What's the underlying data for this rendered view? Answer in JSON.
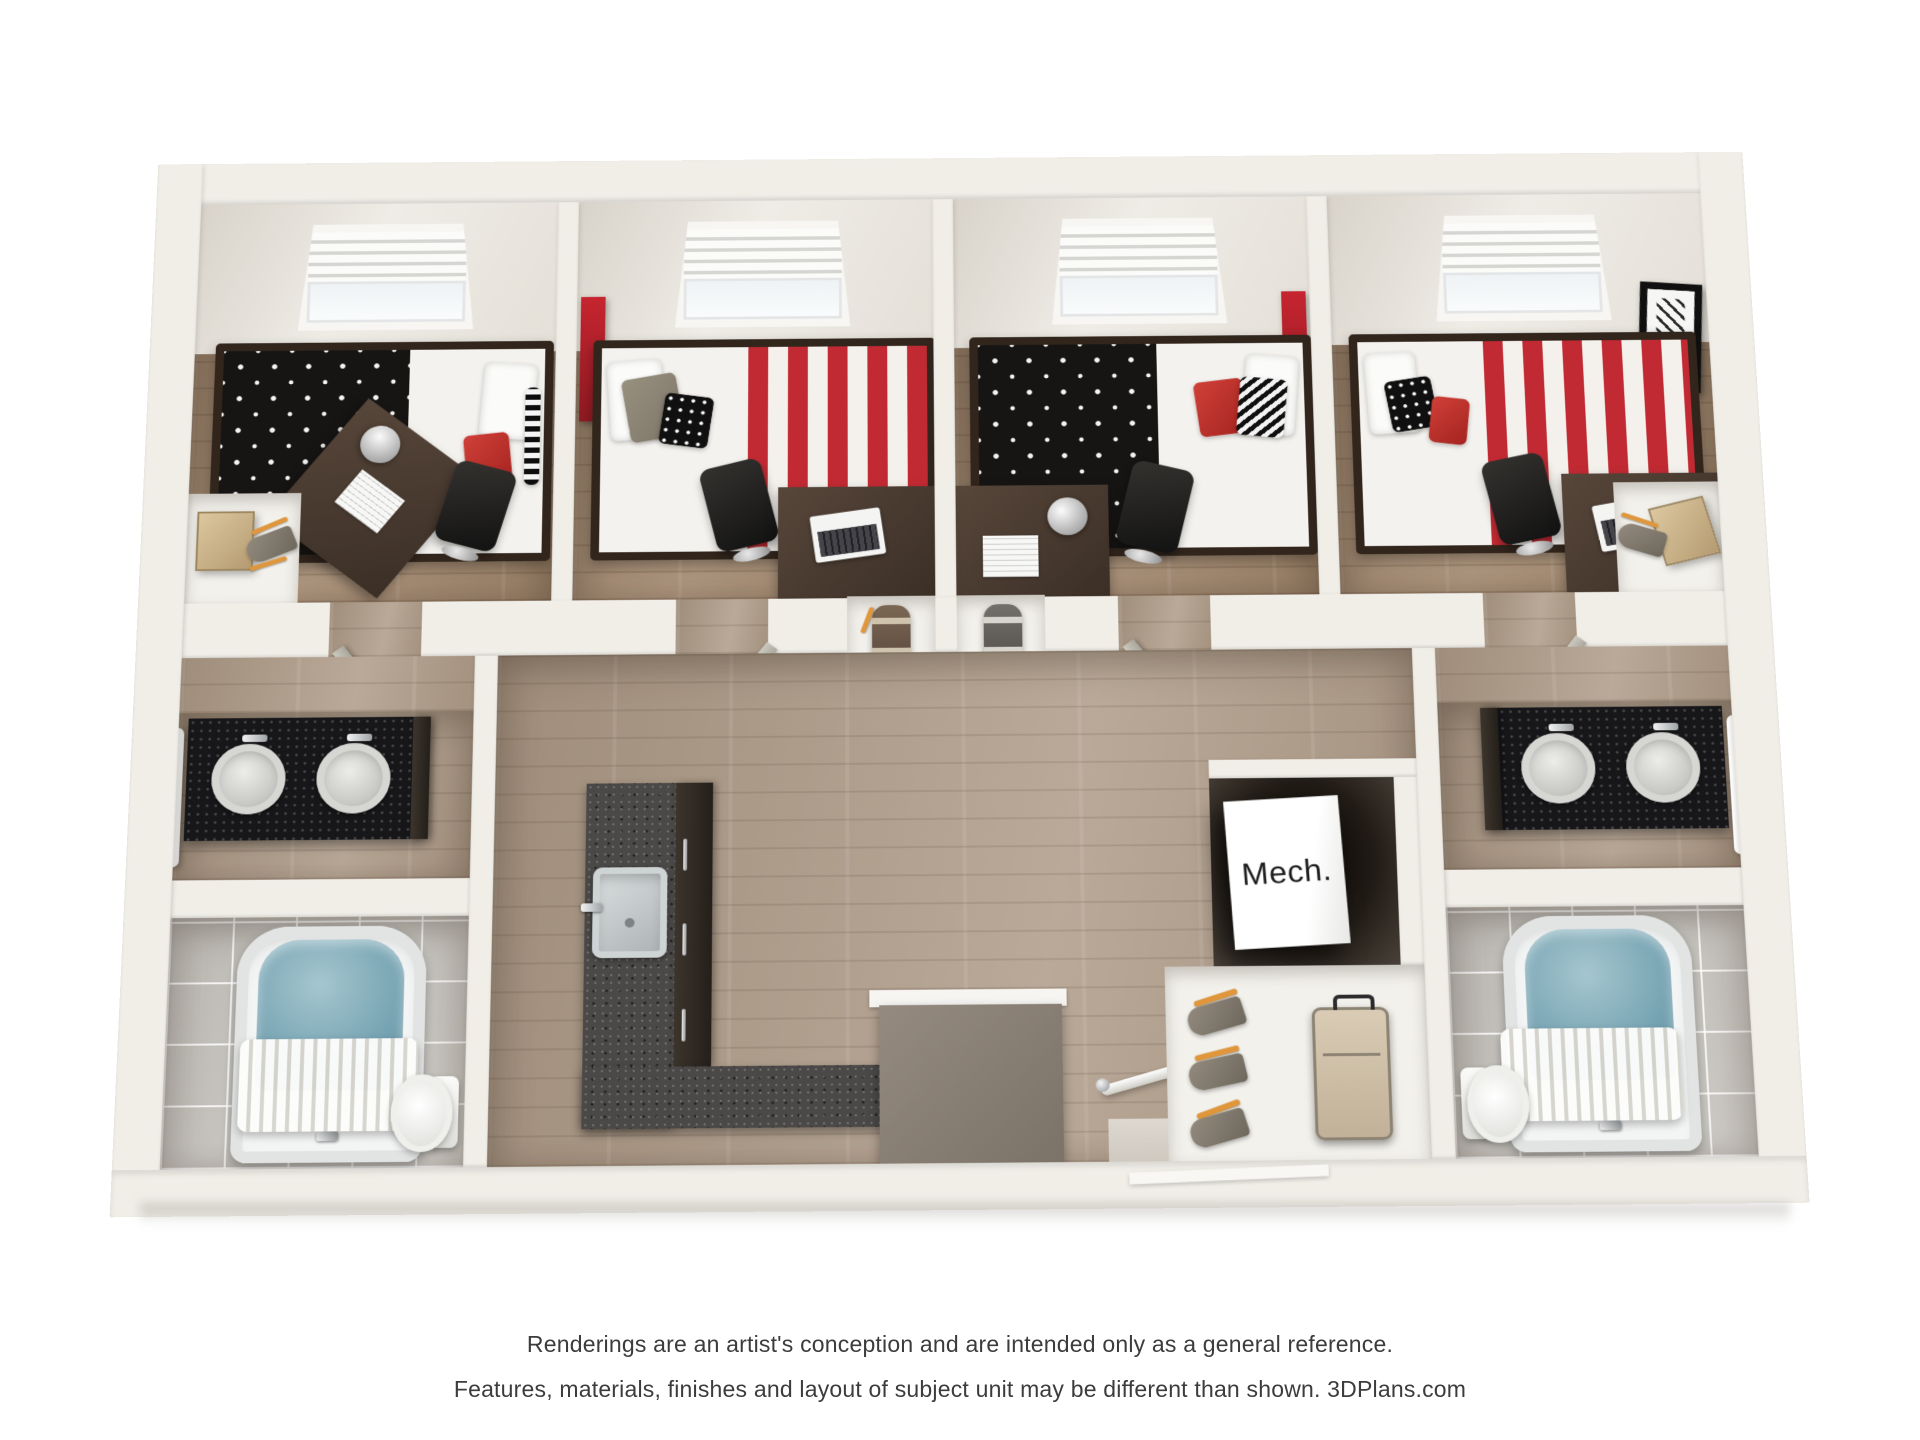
{
  "image_type": "3d-floorplan-rendering",
  "plan": {
    "mech_label": "Mech.",
    "rooms": [
      "bedroom-1",
      "bedroom-2",
      "bedroom-3",
      "bedroom-4",
      "hallway",
      "vanity-left",
      "vanity-right",
      "bathroom-left",
      "bathroom-right",
      "kitchen",
      "stairs",
      "mech-closet",
      "luggage-closet",
      "entry"
    ],
    "colors": {
      "wall": "#f1eee8",
      "wood_floor": "#a3896f",
      "hall_floor": "#b09d8a",
      "tile_floor": "#c9c6c0",
      "accent_red": "#c22a33",
      "vanity_black": "#17171a",
      "kitchen_granite": "#4b4947",
      "fridge_gray": "#8b8177",
      "water_blue": "#76a3b2",
      "hanger_orange": "#e0973c",
      "suitcase_tan": "#cdbda4"
    }
  },
  "disclaimer": {
    "line1": "Renderings are an artist's conception and are intended only as a general reference.",
    "line2": "Features, materials, finishes and layout of subject unit may be different than shown. 3DPlans.com"
  }
}
